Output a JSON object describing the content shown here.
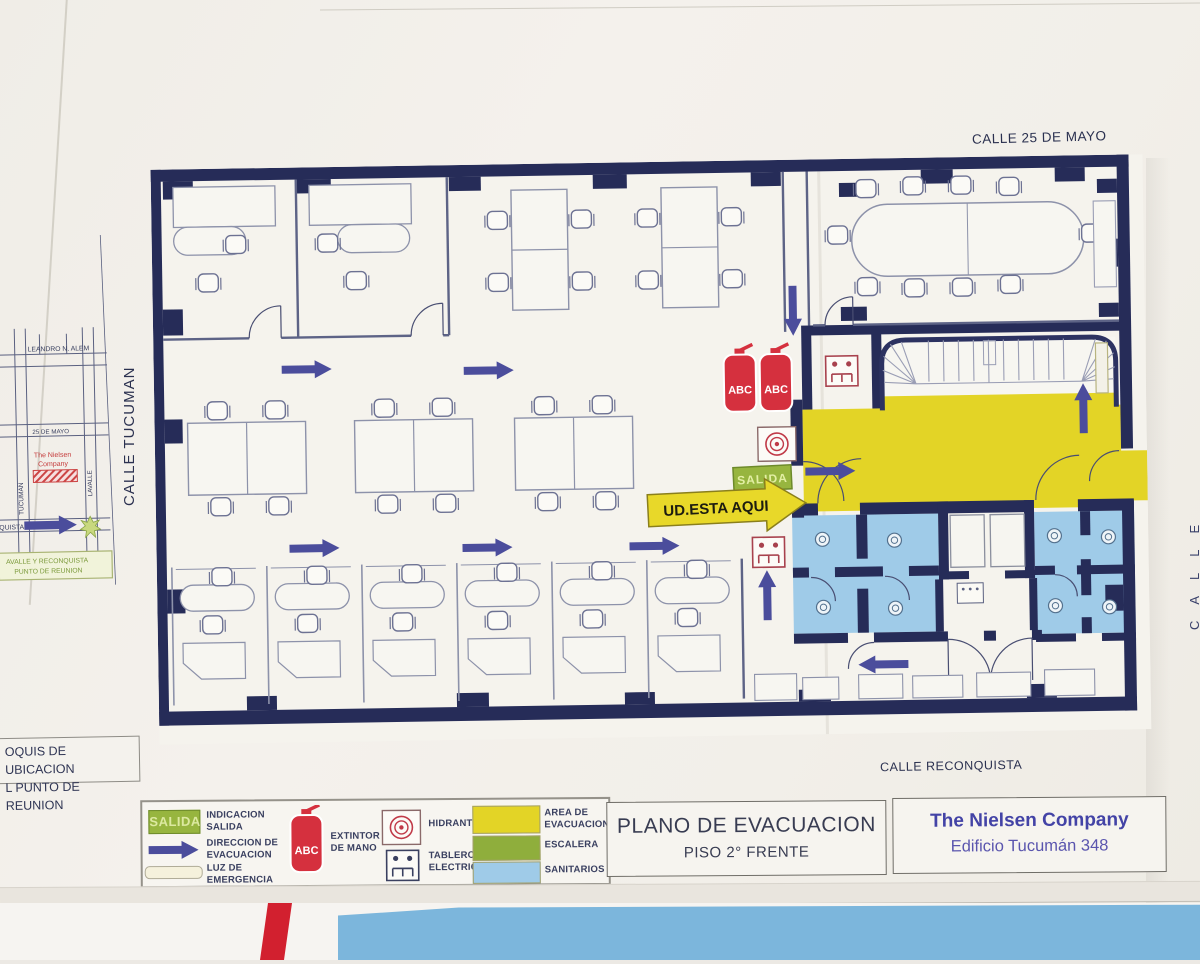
{
  "streets": {
    "top": "CALLE 25 DE MAYO",
    "left": "CALLE TUCUMAN",
    "bottom": "CALLE RECONQUISTA",
    "right_partial": "CALLE"
  },
  "croquis": {
    "caption": {
      "line1": "OQUIS DE UBICACION",
      "line2": "L PUNTO DE REUNION"
    },
    "streets": {
      "alem": "LEANDRO N. ALEM",
      "tucuman": "TUCUMAN",
      "mayo": "25 DE MAYO",
      "lavalle": "LAVALLE",
      "reconquista_partial": "QUISTA"
    },
    "company": {
      "line1": "The Nielsen",
      "line2": "Company"
    },
    "meeting_point": {
      "line1": "AVALLE Y RECONQUISTA",
      "line2": "PUNTO DE REUNION"
    }
  },
  "plan": {
    "exit_badge": "SALIDA",
    "you_are_here": "UD.ESTA AQUI",
    "extinguisher_1": "ABC",
    "extinguisher_2": "ABC"
  },
  "legend": {
    "exit_badge": "SALIDA",
    "extinguisher_label_text": "ABC",
    "items": {
      "indicacion": "INDICACION\nSALIDA",
      "direccion": "DIRECCION DE\nEVACUACION",
      "luz": "LUZ DE\nEMERGENCIA",
      "extintor": "EXTINTOR\nDE MANO",
      "hidrante": "HIDRANTE",
      "tablero": "TABLERO\nELECTRICO",
      "area": "AREA DE\nEVACUACION",
      "escalera": "ESCALERA",
      "sanitarios": "SANITARIOS"
    }
  },
  "title_block": {
    "title": "PLANO DE EVACUACION",
    "subtitle": "PISO 2° FRENTE"
  },
  "company_block": {
    "name": "The Nielsen Company",
    "address": "Edificio Tucumán 348"
  },
  "colors": {
    "wall": "#262c58",
    "arrow": "#4b4d9c",
    "evacuation_area": "#e3d426",
    "stair_green": "#8fae3c",
    "sanitarios_blue": "#9fcbe8",
    "extinguisher_red": "#d5303e",
    "brand_blue": "#4343a6"
  }
}
